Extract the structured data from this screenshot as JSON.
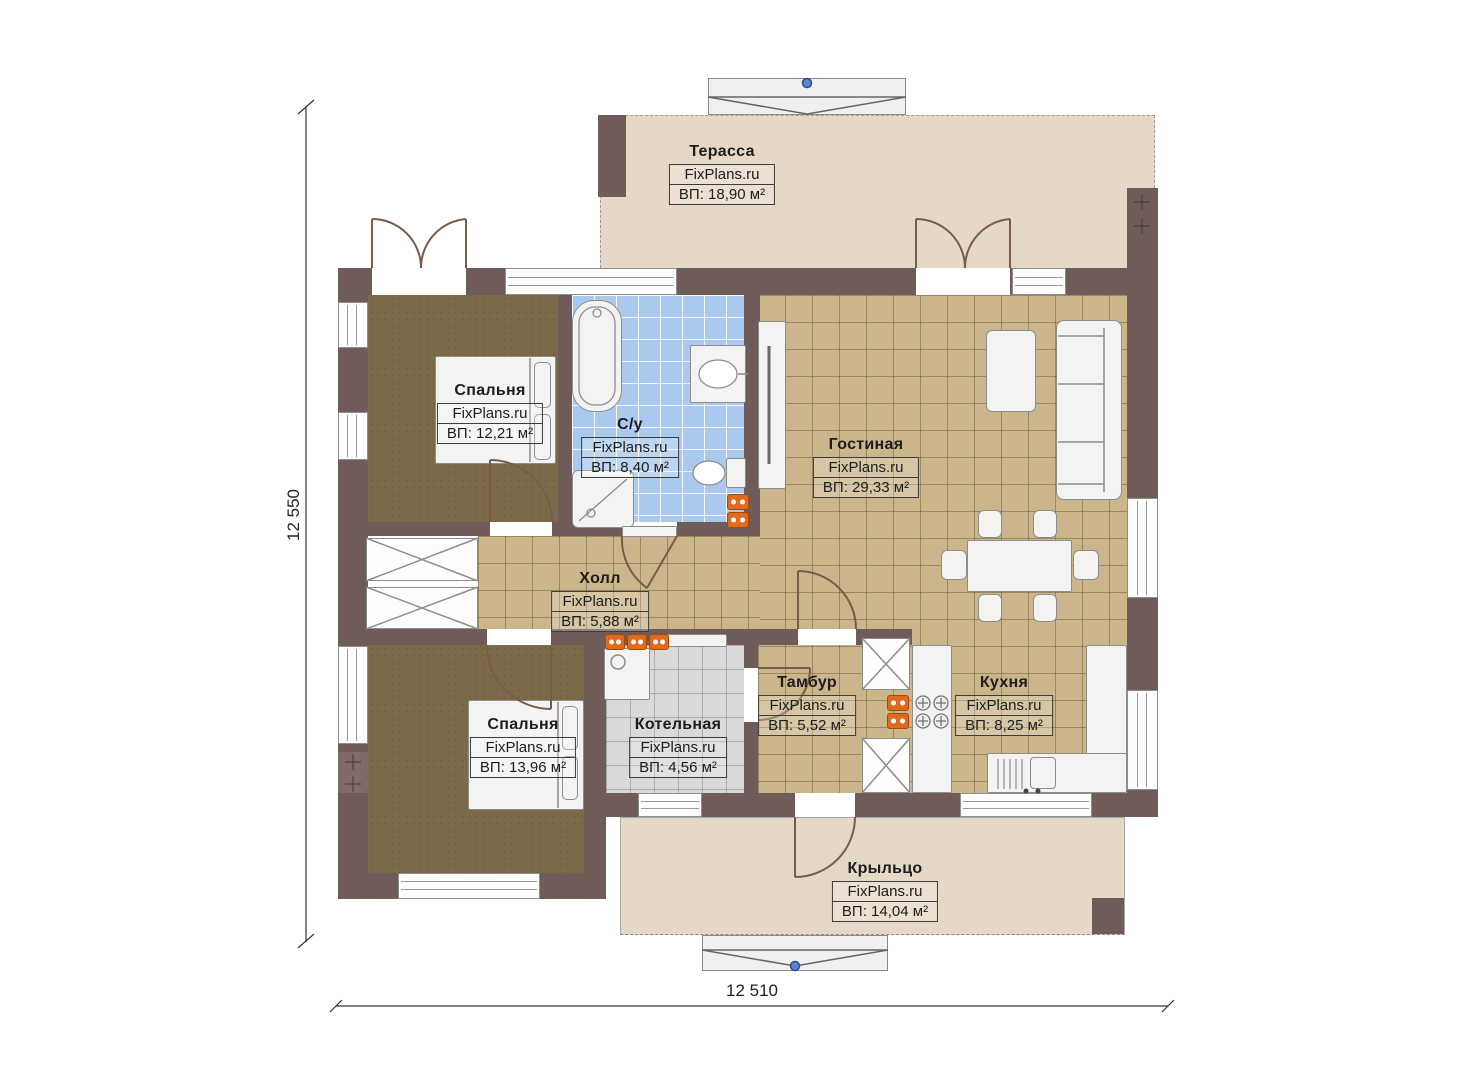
{
  "plan": {
    "rooms": [
      {
        "id": "terrace",
        "name": "Терасса",
        "watermark": "FixPlans.ru",
        "area": "ВП: 18,90 м²"
      },
      {
        "id": "bedroom-1",
        "name": "Спальня",
        "watermark": "FixPlans.ru",
        "area": "ВП: 12,21 м²"
      },
      {
        "id": "bathroom",
        "name": "С/у",
        "watermark": "FixPlans.ru",
        "area": "ВП: 8,40 м²"
      },
      {
        "id": "living-room",
        "name": "Гостиная",
        "watermark": "FixPlans.ru",
        "area": "ВП: 29,33 м²"
      },
      {
        "id": "hall",
        "name": "Холл",
        "watermark": "FixPlans.ru",
        "area": "ВП: 5,88 м²"
      },
      {
        "id": "bedroom-2",
        "name": "Спальня",
        "watermark": "FixPlans.ru",
        "area": "ВП: 13,96 м²"
      },
      {
        "id": "boiler-room",
        "name": "Котельная",
        "watermark": "FixPlans.ru",
        "area": "ВП: 4,56 м²"
      },
      {
        "id": "vestibule",
        "name": "Тамбур",
        "watermark": "FixPlans.ru",
        "area": "ВП: 5,52 м²"
      },
      {
        "id": "kitchen",
        "name": "Кухня",
        "watermark": "FixPlans.ru",
        "area": "ВП: 8,25 м²"
      },
      {
        "id": "porch",
        "name": "Крыльцо",
        "watermark": "FixPlans.ru",
        "area": "ВП: 14,04 м²"
      }
    ],
    "dimensions": {
      "left_vertical": "12 550",
      "bottom_horizontal": "12 510"
    },
    "colors": {
      "wall": "#6f5c59",
      "tile_floor": "#cbb68b",
      "bathroom_tile": "#a9c9ee",
      "bedroom_floor": "#7b6a49",
      "terrace_floor": "#e6d8c6",
      "boiler_tile": "#d9d9d9",
      "socket_orange": "#e06a1e",
      "marker_blue": "#4a78c8"
    }
  }
}
